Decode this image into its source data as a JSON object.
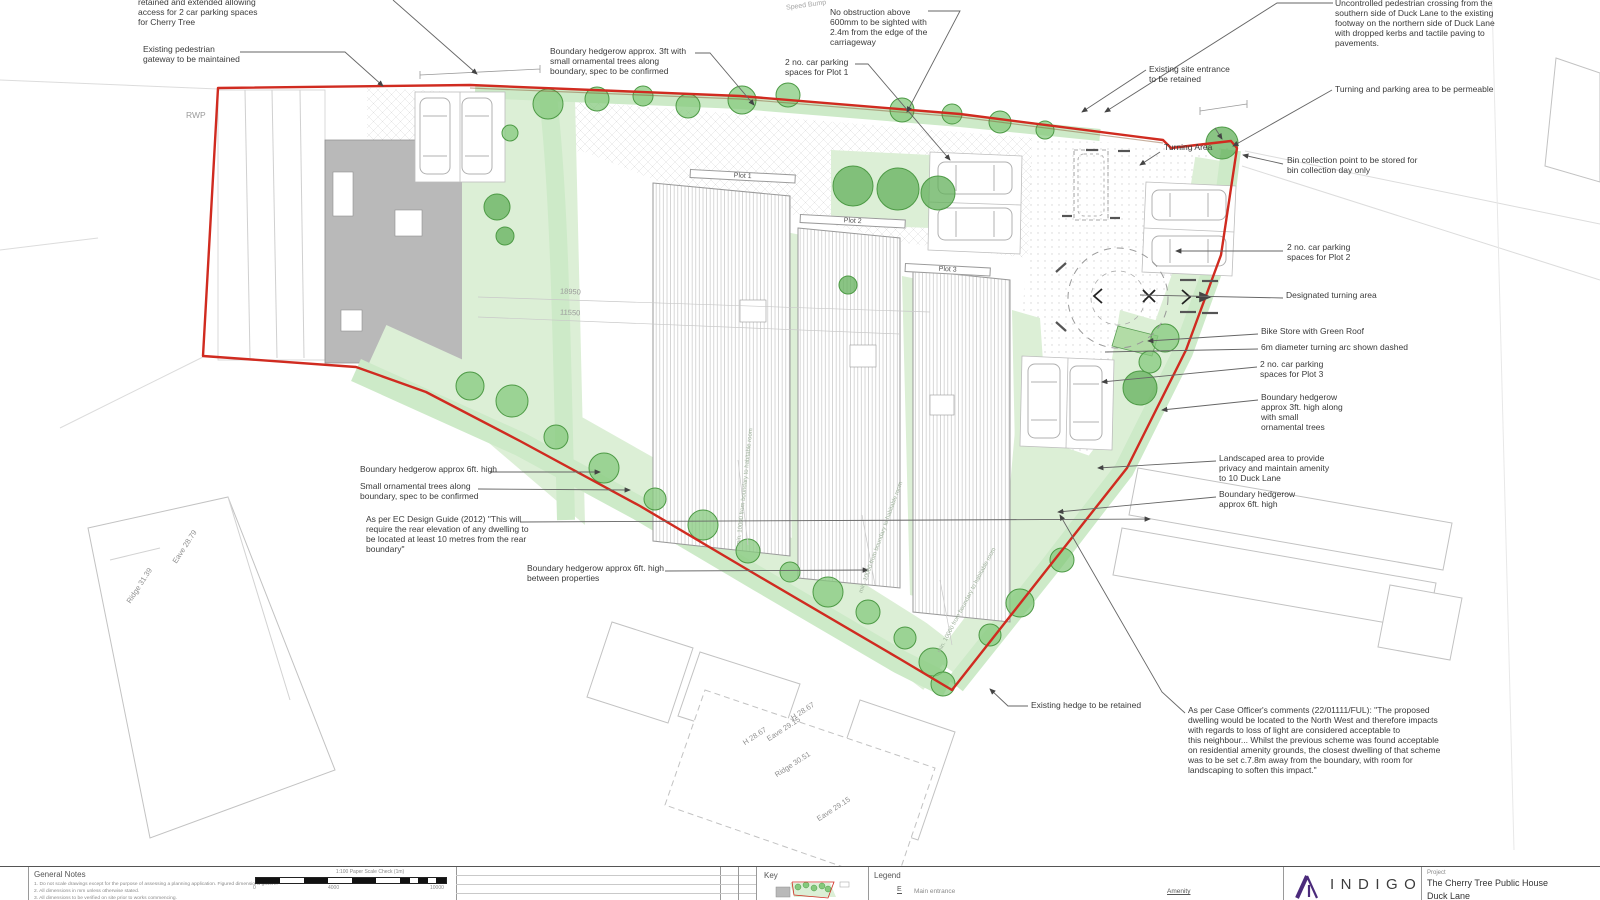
{
  "callouts": {
    "cherry_parking": "retained and extended allowing\naccess for 2 car parking spaces\nfor Cherry Tree",
    "pedestrian_gateway": "Existing pedestrian\ngateway to be maintained",
    "hedgerow_3ft_top": "Boundary hedgerow approx. 3ft with\nsmall ornamental trees along\nboundary, spec to be confirmed",
    "no_obstruction": "No obstruction above\n600mm to be sighted with\n2.4m from the edge of the\ncarriageway",
    "parking_plot1": "2 no. car parking\nspaces for Plot 1",
    "pedestrian_crossing": "Uncontrolled pedestrian crossing from the\nsouthern side of Duck Lane to the existing\nfootway on the northern side of Duck Lane\nwith dropped kerbs and tactile paving to\npavements.",
    "site_entrance": "Existing site entrance\nto be retained",
    "permeable_area": "Turning and parking area to be permeable",
    "bin_collection": "Bin collection point to be stored for\nbin collection day only",
    "parking_plot2": "2 no. car parking\nspaces for Plot 2",
    "designated_turning": "Designated turning area",
    "bike_store": "Bike Store with Green Roof",
    "turning_arc": "6m diameter turning arc shown dashed",
    "parking_plot3": "2 no. car parking\nspaces for Plot 3",
    "hedgerow_3ft_right": "Boundary hedgerow\napprox 3ft. high along\nwith small\nornamental trees",
    "landscaped_area": "Landscaped area to provide\nprivacy and maintain amenity\nto 10 Duck Lane",
    "hedgerow_6ft_right": "Boundary hedgerow\napprox 6ft. high",
    "hedgerow_6ft_left": "Boundary hedgerow approx 6ft. high",
    "small_trees_left": "Small ornamental trees along\nboundary, spec to be confirmed",
    "ec_design_guide": "As per EC Design Guide (2012) \"This will\nrequire the rear elevation of any dwelling to\nbe located at least 10 metres from the rear\nboundary\"",
    "hedgerow_between": "Boundary hedgerow approx 6ft. high\nbetween properties",
    "existing_hedge": "Existing hedge to be retained",
    "case_officer": "As per Case Officer's comments (22/01111/FUL): \"The proposed\ndwelling would be located to the North West and therefore impacts\nwith regards to loss of light are considered acceptable to\nthis neighbour... Whilst the previous scheme was found acceptable\non residential amenity grounds, the closest dwelling of that scheme\nwas to be set c.7.8m away from the boundary, with room for\nlandscaping to soften this impact.\""
  },
  "plan_labels": {
    "rwp": "RWP",
    "speed_bump": "Speed Bump",
    "turning_area": "Turning Area",
    "plot1": "Plot 1",
    "plot2": "Plot 2",
    "plot3": "Plot 3",
    "dim_18950": "18950",
    "dim_11550": "11550",
    "min_boundary": "min. 10000 from boundary to habitable room",
    "eave_2879": "Eave 28.79",
    "ridge_3139": "Ridge 31.39",
    "h_2867_a": "H 28.67",
    "h_2867_b": "H 28.67",
    "eave_2915_a": "Eave 29.15",
    "ridge_3051": "Ridge 30.51",
    "eave_2915_b": "Eave 29.15"
  },
  "title_block": {
    "general_notes_title": "General Notes",
    "note_1": "1. Do not scale drawings except for the purpose of assessing a planning application. Figured dimensions govern.",
    "note_2": "2. All dimensions in mm unless otherwise stated.",
    "note_3": "3. All dimensions to be verified on site prior to works commencing.",
    "scale_caption": "1:100 Paper Scale Check (1m)",
    "scale_0": "0",
    "scale_mid": "4000",
    "scale_end": "10000",
    "key_title": "Key",
    "legend_title": "Legend",
    "legend_symbol_e": "E",
    "legend_main_entrance": "Main entrance",
    "legend_amenity": "Amenity",
    "logo_text": "INDIGO",
    "project_label": "Project",
    "project_name": "The Cherry Tree Public House",
    "project_address": "Duck Lane"
  },
  "colors": {
    "site_boundary_red": "#d02b20",
    "hedge_brown": "#8a5a33",
    "tree_green": "#86c97d",
    "landscape_green": "#dcefd6",
    "building_grey": "#b9b9b9",
    "indigo_brand": "#4b2a7b"
  }
}
